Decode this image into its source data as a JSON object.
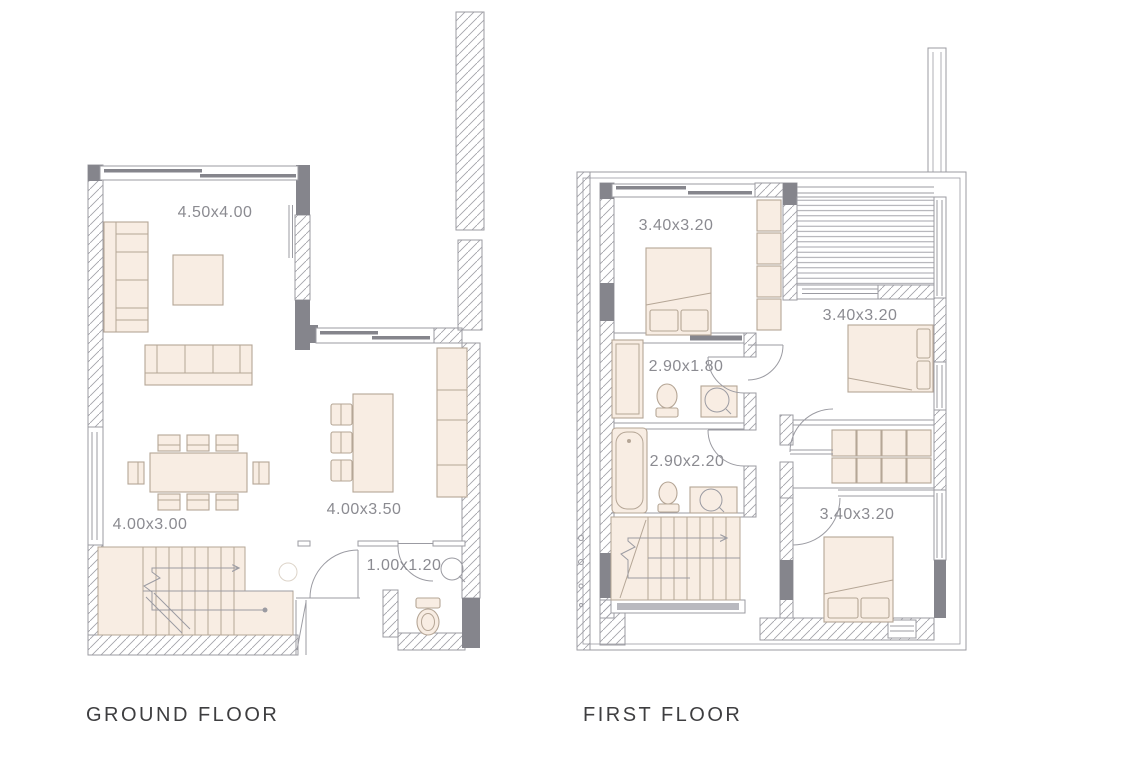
{
  "colors": {
    "wall": "#85858c",
    "line": "#9b9ba2",
    "furn_fill": "#f8ede3",
    "furn_stroke": "#b5a696",
    "dim": "#8b8b91",
    "title": "#3e3e40",
    "bg": "#ffffff"
  },
  "floors": [
    {
      "id": "ground",
      "title": "GROUND FLOOR",
      "rooms": [
        {
          "id": "living-room",
          "label": "4.50x4.00"
        },
        {
          "id": "dining-area",
          "label": "4.00x3.00"
        },
        {
          "id": "kitchen",
          "label": "4.00x3.50"
        },
        {
          "id": "wc",
          "label": "1.00x1.20"
        }
      ]
    },
    {
      "id": "first",
      "title": "FIRST FLOOR",
      "rooms": [
        {
          "id": "bedroom-front",
          "label": "3.40x3.20"
        },
        {
          "id": "bathroom-small",
          "label": "2.90x1.80"
        },
        {
          "id": "bedroom-middle",
          "label": "3.40x3.20"
        },
        {
          "id": "bathroom-large",
          "label": "2.90x2.20"
        },
        {
          "id": "bedroom-back",
          "label": "3.40x3.20"
        }
      ]
    }
  ]
}
